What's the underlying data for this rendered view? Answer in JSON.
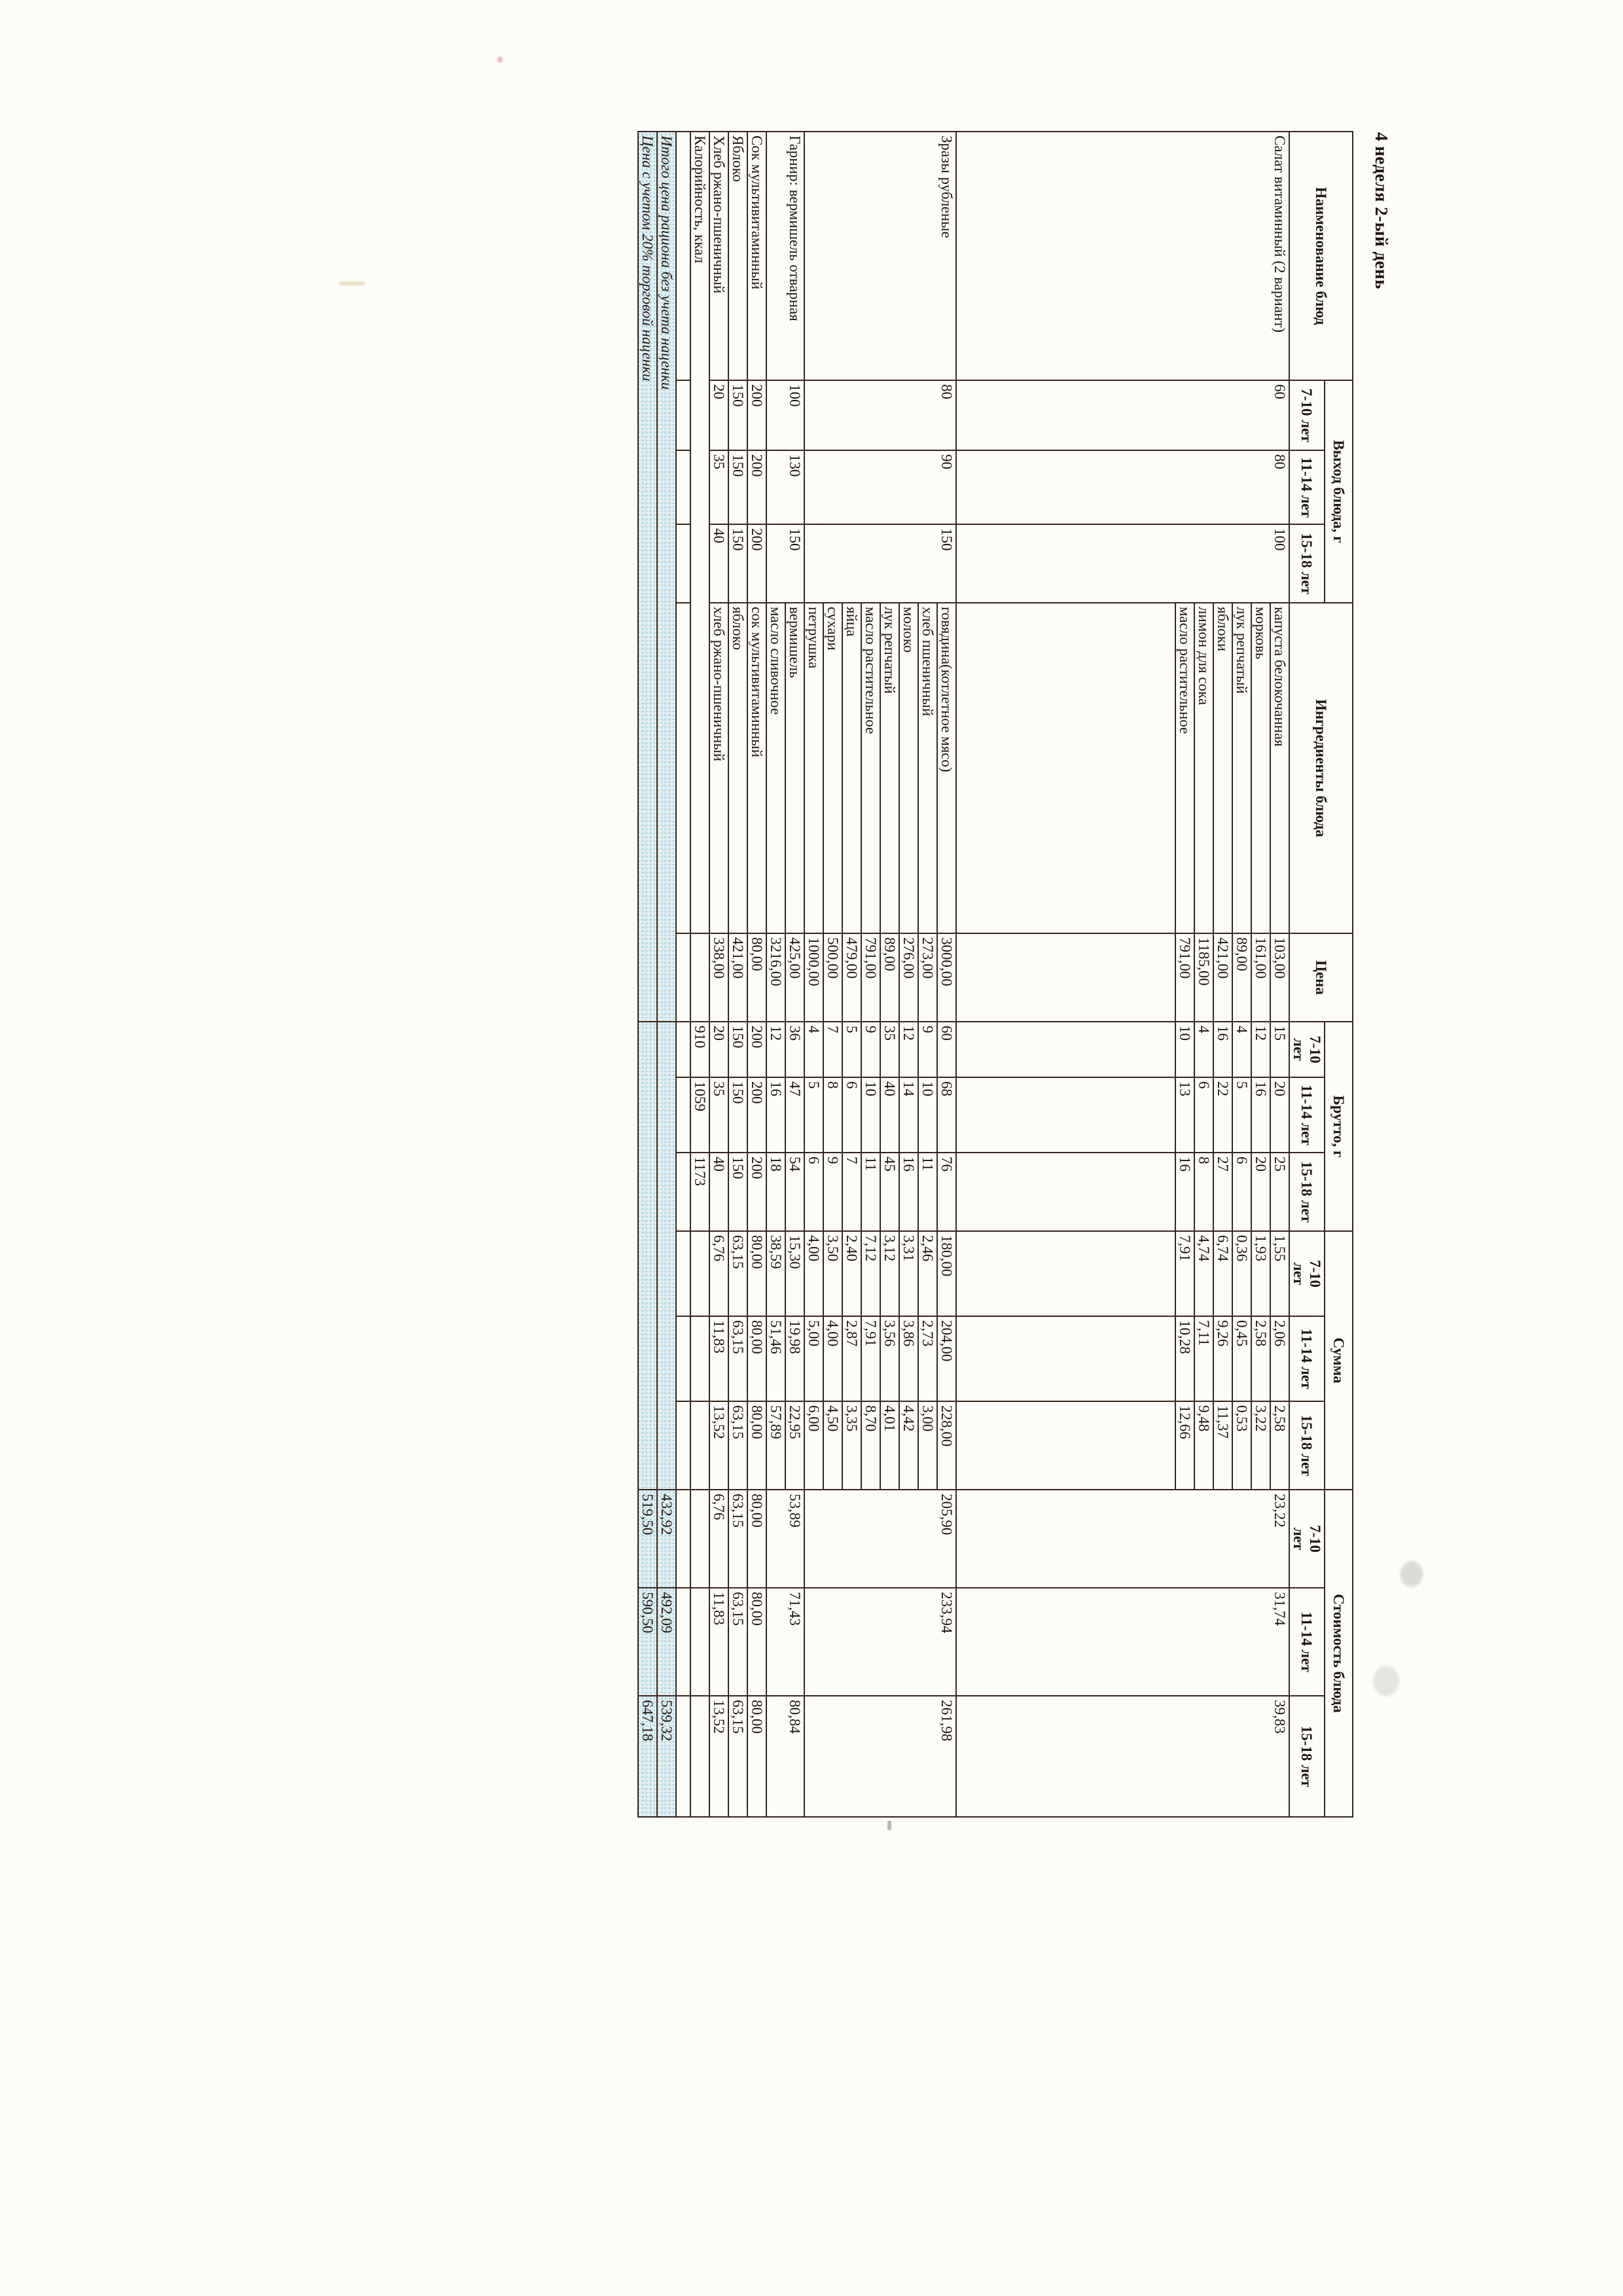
{
  "page_title": "4 неделя 2-ый день",
  "header": {
    "dish": "Наименование блюд",
    "yield_group": "Выход блюда, г",
    "ingredients": "Ингредиенты блюда",
    "price": "Цена",
    "gross_group": "Брутто, г",
    "sum_group": "Сумма",
    "cost_group": "Стоимость блюда",
    "age_short": [
      "7-10 лет",
      "11-14 лет",
      "15-18 лет"
    ],
    "age_wrapped": [
      "7-10\nлет",
      "11-14 лет",
      "15-18 лет"
    ]
  },
  "dishes": [
    {
      "name": "Салат витаминный (2 вариант)",
      "yield": [
        "60",
        "80",
        "100"
      ],
      "cost": [
        "23,22",
        "31,74",
        "39,83"
      ],
      "spacer": 335,
      "ingredients": [
        {
          "name": "капуста белокочанная",
          "price": "103,00",
          "gross": [
            "15",
            "20",
            "25"
          ],
          "sum": [
            "1,55",
            "2,06",
            "2,58"
          ]
        },
        {
          "name": "морковь",
          "price": "161,00",
          "gross": [
            "12",
            "16",
            "20"
          ],
          "sum": [
            "1,93",
            "2,58",
            "3,22"
          ]
        },
        {
          "name": "лук репчатый",
          "price": "89,00",
          "gross": [
            "4",
            "5",
            "6"
          ],
          "sum": [
            "0,36",
            "0,45",
            "0,53"
          ]
        },
        {
          "name": "яблоки",
          "price": "421,00",
          "gross": [
            "16",
            "22",
            "27"
          ],
          "sum": [
            "6,74",
            "9,26",
            "11,37"
          ]
        },
        {
          "name": "лимон для сока",
          "price": "1185,00",
          "gross": [
            "4",
            "6",
            "8"
          ],
          "sum": [
            "4,74",
            "7,11",
            "9,48"
          ]
        },
        {
          "name": "масло растительное",
          "price": "791,00",
          "gross": [
            "10",
            "13",
            "16"
          ],
          "sum": [
            "7,91",
            "10,28",
            "12,66"
          ]
        }
      ]
    },
    {
      "name": "Зразы рубленые",
      "yield": [
        "80",
        "90",
        "150"
      ],
      "cost": [
        "205,90",
        "233,94",
        "261,98"
      ],
      "spacer": 0,
      "ingredients": [
        {
          "name": "говядина(котлетное мясо)",
          "price": "3000,00",
          "gross": [
            "60",
            "68",
            "76"
          ],
          "sum": [
            "180,00",
            "204,00",
            "228,00"
          ]
        },
        {
          "name": "хлеб пшеничный",
          "price": "273,00",
          "gross": [
            "9",
            "10",
            "11"
          ],
          "sum": [
            "2,46",
            "2,73",
            "3,00"
          ]
        },
        {
          "name": "молоко",
          "price": "276,00",
          "gross": [
            "12",
            "14",
            "16"
          ],
          "sum": [
            "3,31",
            "3,86",
            "4,42"
          ]
        },
        {
          "name": "лук репчатый",
          "price": "89,00",
          "gross": [
            "35",
            "40",
            "45"
          ],
          "sum": [
            "3,12",
            "3,56",
            "4,01"
          ]
        },
        {
          "name": "масло растительное",
          "price": "791,00",
          "gross": [
            "9",
            "10",
            "11"
          ],
          "sum": [
            "7,12",
            "7,91",
            "8,70"
          ]
        },
        {
          "name": "яйца",
          "price": "479,00",
          "gross": [
            "5",
            "6",
            "7"
          ],
          "sum": [
            "2,40",
            "2,87",
            "3,35"
          ]
        },
        {
          "name": "сухари",
          "price": "500,00",
          "gross": [
            "7",
            "8",
            "9"
          ],
          "sum": [
            "3,50",
            "4,00",
            "4,50"
          ]
        },
        {
          "name": "петрушка",
          "price": "1000,00",
          "gross": [
            "4",
            "5",
            "6"
          ],
          "sum": [
            "4,00",
            "5,00",
            "6,00"
          ]
        }
      ]
    },
    {
      "name": "Гарнир: вермишель отварная",
      "yield": [
        "100",
        "130",
        "150"
      ],
      "cost": [
        "53,89",
        "71,43",
        "80,84"
      ],
      "spacer": 0,
      "ingredients": [
        {
          "name": "вермишель",
          "price": "425,00",
          "gross": [
            "36",
            "47",
            "54"
          ],
          "sum": [
            "15,30",
            "19,98",
            "22,95"
          ]
        },
        {
          "name": "масло сливочное",
          "price": "3216,00",
          "gross": [
            "12",
            "16",
            "18"
          ],
          "sum": [
            "38,59",
            "51,46",
            "57,89"
          ]
        }
      ]
    },
    {
      "name": "Сок мультивитаминный",
      "yield": [
        "200",
        "200",
        "200"
      ],
      "cost": [
        "80,00",
        "80,00",
        "80,00"
      ],
      "spacer": 0,
      "ingredients": [
        {
          "name": "сок мультивитаминный",
          "price": "80,00",
          "gross": [
            "200",
            "200",
            "200"
          ],
          "sum": [
            "80,00",
            "80,00",
            "80,00"
          ]
        }
      ]
    },
    {
      "name": "Яблоко",
      "yield": [
        "150",
        "150",
        "150"
      ],
      "cost": [
        "63,15",
        "63,15",
        "63,15"
      ],
      "spacer": 0,
      "ingredients": [
        {
          "name": "яблоко",
          "price": "421,00",
          "gross": [
            "150",
            "150",
            "150"
          ],
          "sum": [
            "63,15",
            "63,15",
            "63,15"
          ]
        }
      ]
    },
    {
      "name": "Хлеб ржано-пшеничный",
      "yield": [
        "20",
        "35",
        "40"
      ],
      "cost": [
        "6,76",
        "11,83",
        "13,52"
      ],
      "spacer": 0,
      "ingredients": [
        {
          "name": "хлеб ржано-пшеничный",
          "price": "338,00",
          "gross": [
            "20",
            "35",
            "40"
          ],
          "sum": [
            "6,76",
            "11,83",
            "13,52"
          ]
        }
      ]
    }
  ],
  "calories": {
    "label": "Калорийность, ккал",
    "values": [
      "910",
      "1059",
      "1173"
    ]
  },
  "totals": [
    {
      "label": "Итого цена рациона без учета наценки",
      "values": [
        "432,92",
        "492,09",
        "539,32"
      ]
    },
    {
      "label": "Цена с учетом 20% торговой наценки",
      "values": [
        "519,50",
        "590,50",
        "647,18"
      ]
    }
  ],
  "colors": {
    "border": "#36261a",
    "text": "#211710",
    "highlight": "#e0eff3",
    "highlight_dot_cyan": "#8fd0e2",
    "highlight_dot_peach": "#f0c39e",
    "paper": "#fcfcf9"
  }
}
